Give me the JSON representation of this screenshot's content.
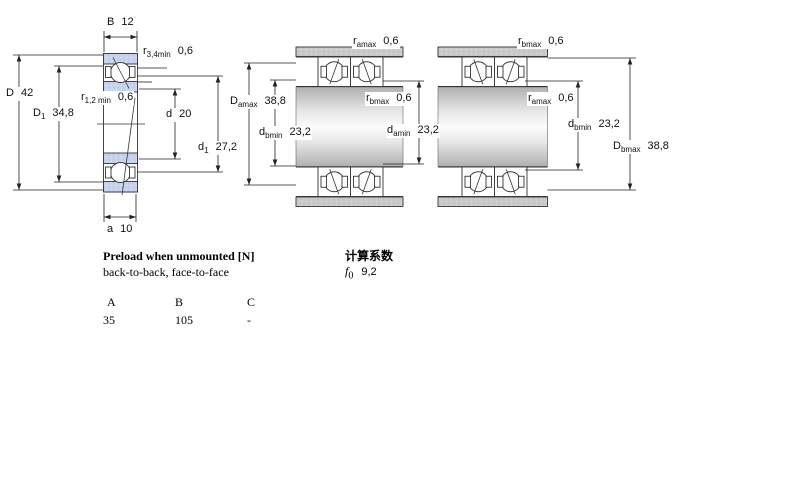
{
  "labels": {
    "single": {
      "B": {
        "sym": "B",
        "sub": "",
        "val": "12"
      },
      "r34": {
        "sym": "r",
        "sub": "3,4min",
        "val": "0,6"
      },
      "D": {
        "sym": "D",
        "sub": "",
        "val": "42"
      },
      "D1": {
        "sym": "D",
        "sub": "1",
        "val": "34,8"
      },
      "r12": {
        "sym": "r",
        "sub": "1,2 min",
        "val": "0,6"
      },
      "d": {
        "sym": "d",
        "sub": "",
        "val": "20"
      },
      "d1": {
        "sym": "d",
        "sub": "1",
        "val": "27,2"
      },
      "a": {
        "sym": "a",
        "sub": "",
        "val": "10"
      }
    },
    "pair_mid": {
      "ramax": {
        "sym": "r",
        "sub": "amax",
        "val": "0,6"
      },
      "Damax": {
        "sym": "D",
        "sub": "amax",
        "val": "38,8"
      },
      "dbmin": {
        "sym": "d",
        "sub": "bmin",
        "val": "23,2"
      },
      "rbmax": {
        "sym": "r",
        "sub": "bmax",
        "val": "0,6"
      },
      "damin": {
        "sym": "d",
        "sub": "amin",
        "val": "23,2"
      }
    },
    "pair_right": {
      "rbmax": {
        "sym": "r",
        "sub": "bmax",
        "val": "0,6"
      },
      "ramax": {
        "sym": "r",
        "sub": "amax",
        "val": "0,6"
      },
      "dbmin": {
        "sym": "d",
        "sub": "bmin",
        "val": "23,2"
      },
      "Dbmax": {
        "sym": "D",
        "sub": "bmax",
        "val": "38,8"
      }
    }
  },
  "preload": {
    "title": "Preload when unmounted [N]",
    "subtitle": "back-to-back, face-to-face",
    "columns": [
      "A",
      "B",
      "C"
    ],
    "values": [
      "35",
      "105",
      "-"
    ]
  },
  "calc": {
    "title": "计算系数",
    "f_sym": "f",
    "f_sub": "0",
    "f_val": "9,2"
  }
}
